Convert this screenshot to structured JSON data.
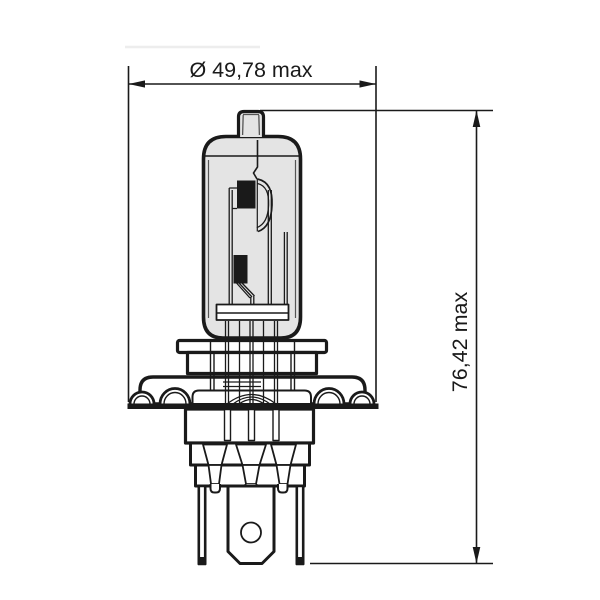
{
  "dimensions": {
    "diameter": {
      "symbol": "Ø",
      "value": "49,78",
      "qualifier": "max",
      "label": "Ø 49,78 max"
    },
    "height": {
      "value": "76,42",
      "qualifier": "max",
      "label": "76,42 max"
    }
  },
  "colors": {
    "line": "#1a1a1a",
    "glass_fill": "#e4e4e4",
    "background": "#ffffff"
  }
}
